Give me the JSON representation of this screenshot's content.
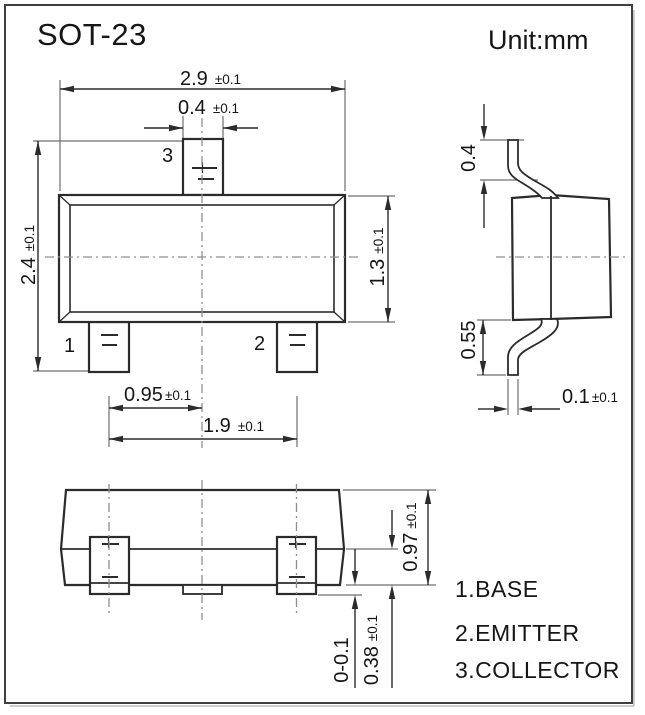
{
  "page": {
    "title": "SOT-23",
    "unit_label": "Unit:mm"
  },
  "dims": {
    "body_width": {
      "value": "2.9",
      "tol": "±0.1"
    },
    "lead3_width": {
      "value": "0.4",
      "tol": "±0.1"
    },
    "overall_length": {
      "value": "2.4",
      "tol": "±0.1"
    },
    "body_length": {
      "value": "1.3",
      "tol": "±0.1"
    },
    "lead_pitch": {
      "value": "0.95",
      "tol": "±0.1"
    },
    "lead_span": {
      "value": "1.9",
      "tol": "±0.1"
    },
    "lead_top_height": {
      "value": "0.4",
      "tol": ""
    },
    "lead_bottom_height": {
      "value": "0.55",
      "tol": ""
    },
    "lead_thickness": {
      "value": "0.1",
      "tol": "±0.1"
    },
    "body_height": {
      "value": "0.97",
      "tol": "±0.1"
    },
    "standoff": {
      "value": "0-0.1",
      "tol": ""
    },
    "shoulder_height": {
      "value": "0.38",
      "tol": "±0.1"
    }
  },
  "pins": {
    "pin1": "1",
    "pin2": "2",
    "pin3": "3"
  },
  "legend": {
    "line1": "1.BASE",
    "line2": "2.EMITTER",
    "line3": "3.COLLECTOR"
  }
}
